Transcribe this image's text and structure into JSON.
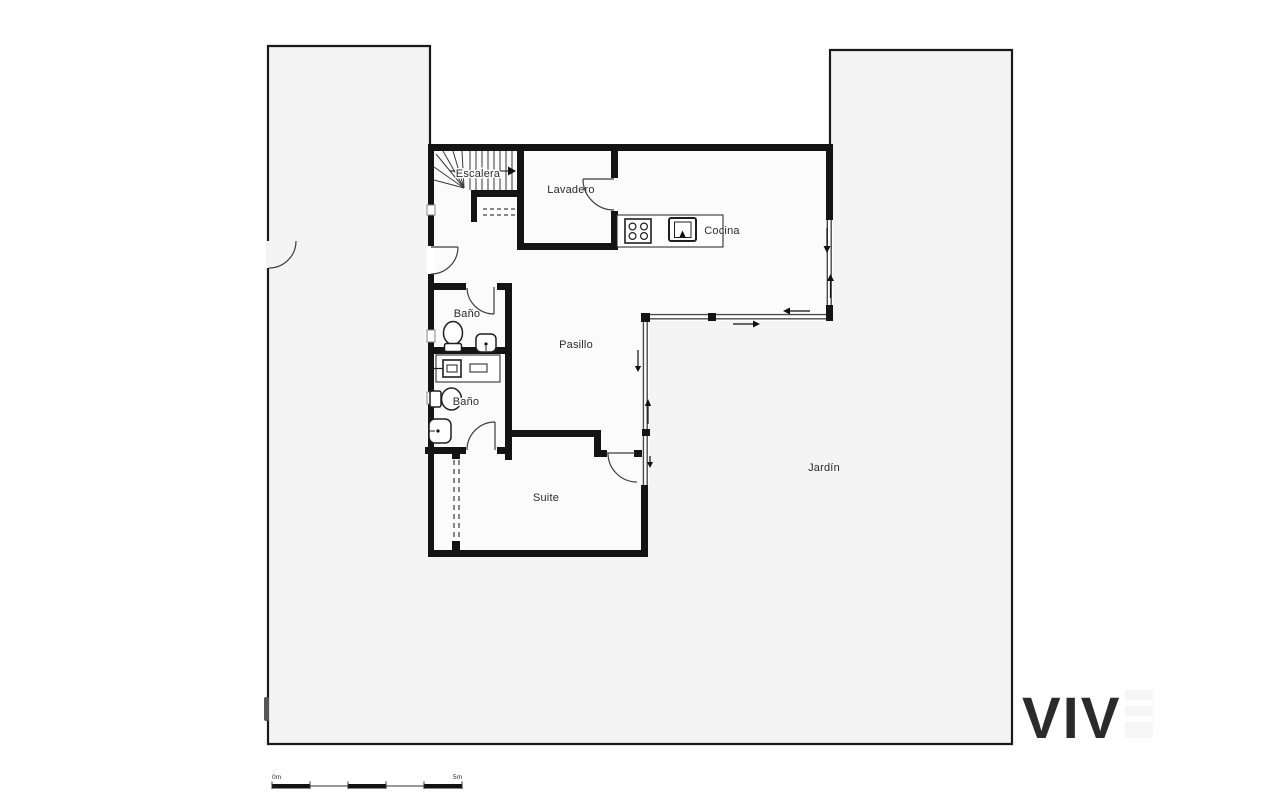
{
  "labels": {
    "escalera": "Escalera",
    "lavadero": "Lavadero",
    "cocina": "Cocina",
    "bano_top": "Baño",
    "bano_bottom": "Baño",
    "pasillo": "Pasillo",
    "suite": "Suite",
    "jardin": "Jardín"
  },
  "scale_bar": {
    "start_label": "0m",
    "end_label": "5m"
  },
  "watermark": "VIV",
  "colors": {
    "wall": "#141414",
    "garden_fill": "#f4f4f5",
    "interior_fill": "#fbfbfb",
    "boundary_line": "#1a1a1a",
    "glass_line": "#4a4a4a",
    "fixture_line": "#1f1f1f",
    "stair_line": "#3a3a3a",
    "arrow": "#111111",
    "watermark_fill": "#f6f6f6"
  }
}
